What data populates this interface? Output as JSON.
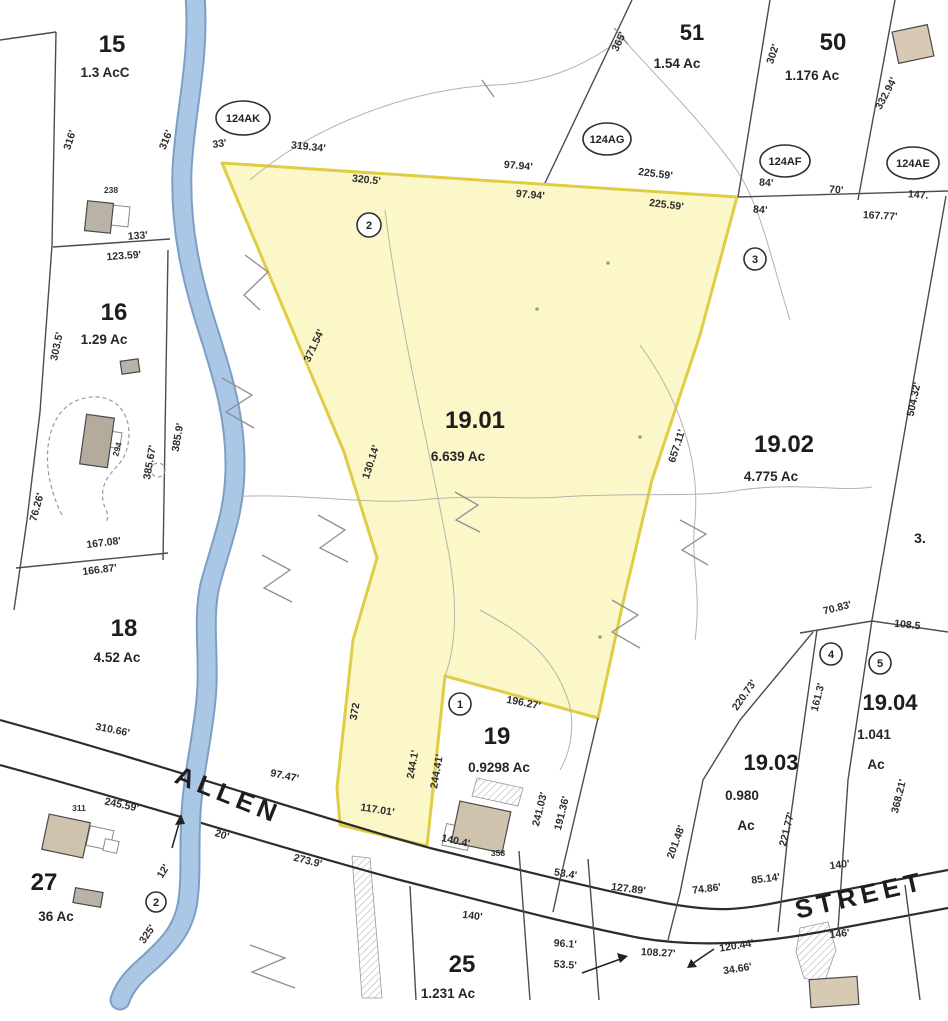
{
  "map": {
    "palette": {
      "highlight_fill": "#fbf6c3",
      "highlight_stroke": "#e0cd45",
      "river_blue": "#aac7e5",
      "river_edge": "#7d9fc6",
      "boundary": "#4c4c4c",
      "road": "#2d2d2d",
      "contour": "#b4b4aa",
      "text": "#262626"
    },
    "highlight": {
      "parcel_id": "19.01",
      "area": "6.639 Ac",
      "points": "222,163 737,197 700,335 652,480 622,607 598,718 445,676 427,846 340,825 337,788 353,640 377,558 344,452"
    },
    "shapes": {
      "river": "M195,-5 C200,60 185,110 182,170 C180,230 192,280 208,330 C224,380 236,420 235,470 C234,515 222,540 210,585 C202,620 210,660 206,700 C202,740 196,760 192,800 C188,840 192,870 188,900 C184,930 168,945 150,962 C135,975 125,985 120,1000",
      "road_casings": [
        {
          "name": "allen-street-upper-edge",
          "d": "M0,720 C160,764 300,812 430,848 C520,870 600,890 665,903 C720,913 740,910 790,900 C830,893 895,880 948,870"
        },
        {
          "name": "allen-street-lower-edge",
          "d": "M0,765 C150,806 280,848 400,880 C490,903 560,922 640,938 C700,948 760,943 820,932 C870,923 910,915 948,908"
        }
      ],
      "boundaries": [
        {
          "name": "map-edge-corner",
          "d": "M0,40 L56,32"
        },
        {
          "name": "west-lot-line",
          "d": "M56,32 L52,245 L40,412 L27,520 L14,610"
        },
        {
          "name": "lot15-16-line",
          "d": "M53,247 L170,239"
        },
        {
          "name": "lot16-east-line",
          "d": "M168,250 L163,560"
        },
        {
          "name": "lot16-18-line",
          "d": "M16,568 L168,553"
        },
        {
          "name": "lot51-west-line",
          "d": "M632,0 L545,183"
        },
        {
          "name": "lot51-50-line",
          "d": "M770,0 L738,197"
        },
        {
          "name": "lot50-east-line",
          "d": "M895,0 L858,200"
        },
        {
          "name": "north-tier-line",
          "d": "M738,197 L948,191"
        },
        {
          "name": "lot1902-east-line",
          "d": "M946,196 L917,360 L872,620"
        },
        {
          "name": "junction-line",
          "d": "M800,633 L872,621 L948,632"
        },
        {
          "name": "lot1903-west-line",
          "d": "M813,632 L740,720 L703,780 L680,893 L668,940"
        },
        {
          "name": "lot1903-1904-line",
          "d": "M817,630 L787,843 L778,932"
        },
        {
          "name": "lot1904-east-line",
          "d": "M872,620 L848,780 L838,930"
        },
        {
          "name": "lot19-east-line",
          "d": "M598,718 L560,880 L553,912"
        },
        {
          "name": "lot25-west-line",
          "d": "M410,886 L416,1000"
        },
        {
          "name": "lot25-east-line",
          "d": "M519,851 L530,1000"
        },
        {
          "name": "narrow-strip-line",
          "d": "M588,859 L599,1000"
        },
        {
          "name": "southeast-lot-line",
          "d": "M905,885 L920,1000"
        }
      ],
      "contours": [
        {
          "name": "contour-north-arc",
          "d": "M250,180 C320,120 420,88 495,85 C560,82 600,55 622,38"
        },
        {
          "name": "contour-northeast",
          "d": "M622,38 C660,80 710,130 740,175 C762,212 772,262 790,320"
        },
        {
          "name": "contour-mid-cross",
          "d": "M230,497 C300,492 360,505 420,500 C480,494 520,500 560,497 C640,492 700,498 740,490 C800,482 840,492 872,487"
        },
        {
          "name": "contour-east",
          "d": "M640,345 C680,400 700,460 695,520 C690,560 702,590 695,640"
        },
        {
          "name": "contour-center-vertical",
          "d": "M385,210 C400,330 430,450 450,560 C458,610 455,650 445,676"
        },
        {
          "name": "contour-south-center",
          "d": "M480,610 C520,632 552,652 568,700 C575,720 572,750 560,770"
        }
      ],
      "zigzags": [
        {
          "name": "stream-mark",
          "d": "M245,255 L268,272 L244,295 L260,310"
        },
        {
          "name": "stream-mark",
          "d": "M222,378 L252,395 L226,412 L254,428"
        },
        {
          "name": "stream-mark",
          "d": "M262,555 L290,570 L264,588 L292,602"
        },
        {
          "name": "stream-mark",
          "d": "M318,515 L345,530 L320,548 L348,562"
        },
        {
          "name": "stream-mark",
          "d": "M455,492 L478,505 L456,520 L480,532"
        },
        {
          "name": "stream-mark",
          "d": "M612,600 L638,615 L612,632 L640,648"
        },
        {
          "name": "stream-mark",
          "d": "M680,520 L706,534 L682,550 L708,565"
        },
        {
          "name": "stream-mark",
          "d": "M250,945 L285,958 L252,972 L295,988"
        },
        {
          "name": "contour-tick",
          "d": "M482,80 L494,97"
        },
        {
          "name": "contour-tick",
          "d": "M614,28 L628,44"
        }
      ],
      "arrows": [
        {
          "name": "dim-arrow",
          "d": "M582,973 L626,957",
          "head": "628,956 617,953 620,963"
        },
        {
          "name": "dim-arrow",
          "d": "M714,949 L689,966",
          "head": "687,968 697,967 691,959"
        },
        {
          "name": "stream-arrow",
          "d": "M172,848 L180,820",
          "head": "181,814 175,825 185,824"
        }
      ],
      "hatched": [
        {
          "name": "dirt-drive-strip",
          "points": "352,856 370,858 382,998 362,998"
        },
        {
          "name": "wetland-patch",
          "points": "800,928 828,922 836,950 824,983 804,978 796,952"
        },
        {
          "name": "driveway-lot19",
          "points": "477,778 523,788 518,806 472,796"
        }
      ],
      "dashed": [
        {
          "name": "driveway-loop-lot16",
          "d": "M62,515 C38,468 44,413 78,400 C112,388 134,412 128,444 C124,468 106,470 103,490 C100,508 112,512 106,522"
        }
      ],
      "buildings": [
        {
          "name": "building-lot15",
          "x": 86,
          "y": 202,
          "w": 26,
          "h": 30,
          "rot": 6,
          "fill": "#b9b2a6"
        },
        {
          "name": "shed-lot16",
          "x": 121,
          "y": 360,
          "w": 18,
          "h": 13,
          "rot": -8,
          "fill": "#b9b2a6"
        },
        {
          "name": "building-lot16",
          "x": 83,
          "y": 416,
          "w": 28,
          "h": 50,
          "rot": 8,
          "fill": "#b5ab9c"
        },
        {
          "name": "building-lot27",
          "x": 45,
          "y": 818,
          "w": 42,
          "h": 36,
          "rot": 12,
          "fill": "#cfc3ae"
        },
        {
          "name": "shed-lot27",
          "x": 74,
          "y": 890,
          "w": 28,
          "h": 15,
          "rot": 10,
          "fill": "#b9b2a6"
        },
        {
          "name": "building-lot19",
          "x": 455,
          "y": 806,
          "w": 52,
          "h": 42,
          "rot": 12,
          "fill": "#cfc3ae"
        },
        {
          "name": "building-northeast",
          "x": 895,
          "y": 28,
          "w": 36,
          "h": 32,
          "rot": -12,
          "fill": "#d8c9b4"
        },
        {
          "name": "building-southeast",
          "x": 810,
          "y": 978,
          "w": 48,
          "h": 28,
          "rot": -4,
          "fill": "#d8c9b4"
        }
      ],
      "building_outlines": [
        {
          "name": "garage-lot15",
          "x": 112,
          "y": 206,
          "w": 17,
          "h": 20,
          "rot": 6
        },
        {
          "name": "step-lot16",
          "x": 111,
          "y": 432,
          "w": 10,
          "h": 16,
          "rot": 8
        },
        {
          "name": "deck-lot27",
          "x": 88,
          "y": 828,
          "w": 24,
          "h": 20,
          "rot": 12
        },
        {
          "name": "deck2-lot27",
          "x": 104,
          "y": 840,
          "w": 14,
          "h": 12,
          "rot": 12
        },
        {
          "name": "garage-lot19",
          "x": 444,
          "y": 826,
          "w": 26,
          "h": 22,
          "rot": 12
        }
      ],
      "dots": [
        {
          "x": 537,
          "y": 309
        },
        {
          "x": 608,
          "y": 263
        },
        {
          "x": 640,
          "y": 437
        },
        {
          "x": 600,
          "y": 637
        }
      ]
    },
    "labels": {
      "parcel_ids": [
        {
          "t": "15",
          "x": 112,
          "y": 52,
          "s": 24
        },
        {
          "t": "16",
          "x": 114,
          "y": 320,
          "s": 24
        },
        {
          "t": "18",
          "x": 124,
          "y": 636,
          "s": 24
        },
        {
          "t": "27",
          "x": 44,
          "y": 890,
          "s": 24
        },
        {
          "t": "51",
          "x": 692,
          "y": 40,
          "s": 22
        },
        {
          "t": "50",
          "x": 833,
          "y": 50,
          "s": 24
        },
        {
          "t": "19",
          "x": 497,
          "y": 744,
          "s": 24
        },
        {
          "t": "19.01",
          "x": 475,
          "y": 428,
          "s": 24
        },
        {
          "t": "19.02",
          "x": 784,
          "y": 452,
          "s": 24
        },
        {
          "t": "19.03",
          "x": 771,
          "y": 770,
          "s": 22
        },
        {
          "t": "19.04",
          "x": 890,
          "y": 710,
          "s": 22
        },
        {
          "t": "25",
          "x": 462,
          "y": 972,
          "s": 24
        },
        {
          "t": "3.",
          "x": 920,
          "y": 543,
          "s": 14
        }
      ],
      "areas": [
        {
          "t": "1.3 AcC",
          "x": 105,
          "y": 77
        },
        {
          "t": "1.29 Ac",
          "x": 104,
          "y": 344
        },
        {
          "t": "4.52 Ac",
          "x": 117,
          "y": 662
        },
        {
          "t": "36 Ac",
          "x": 56,
          "y": 921
        },
        {
          "t": "1.54 Ac",
          "x": 677,
          "y": 68
        },
        {
          "t": "1.176 Ac",
          "x": 812,
          "y": 80
        },
        {
          "t": "6.639 Ac",
          "x": 458,
          "y": 461
        },
        {
          "t": "4.775 Ac",
          "x": 771,
          "y": 481
        },
        {
          "t": "0.9298 Ac",
          "x": 499,
          "y": 772
        },
        {
          "t": "0.980",
          "x": 742,
          "y": 800
        },
        {
          "t": "Ac",
          "x": 746,
          "y": 830
        },
        {
          "t": "1.041",
          "x": 874,
          "y": 739
        },
        {
          "t": "Ac",
          "x": 876,
          "y": 769
        },
        {
          "t": "1.231 Ac",
          "x": 448,
          "y": 998
        }
      ],
      "dims": [
        {
          "t": "316'",
          "x": 73,
          "y": 141,
          "r": -72
        },
        {
          "t": "316'",
          "x": 169,
          "y": 141,
          "r": -68
        },
        {
          "t": "33'",
          "x": 220,
          "y": 147,
          "r": -8
        },
        {
          "t": "319.34'",
          "x": 308,
          "y": 150,
          "r": 6
        },
        {
          "t": "320.5'",
          "x": 366,
          "y": 183,
          "r": 6
        },
        {
          "t": "97.94'",
          "x": 518,
          "y": 169,
          "r": 5
        },
        {
          "t": "97.94'",
          "x": 530,
          "y": 198,
          "r": 5
        },
        {
          "t": "225.59'",
          "x": 655,
          "y": 177,
          "r": 7
        },
        {
          "t": "225.59'",
          "x": 666,
          "y": 208,
          "r": 7
        },
        {
          "t": "84'",
          "x": 766,
          "y": 186,
          "r": 4
        },
        {
          "t": "84'",
          "x": 760,
          "y": 213,
          "r": 4
        },
        {
          "t": "70'",
          "x": 836,
          "y": 193,
          "r": 4
        },
        {
          "t": "147.",
          "x": 918,
          "y": 198,
          "r": 4
        },
        {
          "t": "167.77'",
          "x": 880,
          "y": 219,
          "r": 3
        },
        {
          "t": "332.94'",
          "x": 889,
          "y": 95,
          "r": -62
        },
        {
          "t": "365'",
          "x": 622,
          "y": 43,
          "r": -65
        },
        {
          "t": "302'",
          "x": 776,
          "y": 55,
          "r": -72
        },
        {
          "t": "133'",
          "x": 138,
          "y": 239,
          "r": -4
        },
        {
          "t": "123.59'",
          "x": 124,
          "y": 259,
          "r": -4
        },
        {
          "t": "303.5'",
          "x": 60,
          "y": 347,
          "r": -78
        },
        {
          "t": "385.67'",
          "x": 153,
          "y": 463,
          "r": -80
        },
        {
          "t": "385.9'",
          "x": 181,
          "y": 438,
          "r": -80
        },
        {
          "t": "76.26'",
          "x": 40,
          "y": 508,
          "r": -75
        },
        {
          "t": "167.08'",
          "x": 104,
          "y": 546,
          "r": -7
        },
        {
          "t": "166.87'",
          "x": 100,
          "y": 573,
          "r": -7
        },
        {
          "t": "310.66'",
          "x": 112,
          "y": 733,
          "r": 11
        },
        {
          "t": "97.47'",
          "x": 284,
          "y": 779,
          "r": 12
        },
        {
          "t": "245.59'",
          "x": 121,
          "y": 808,
          "r": 12
        },
        {
          "t": "20'",
          "x": 221,
          "y": 838,
          "r": 18
        },
        {
          "t": "273.9'",
          "x": 307,
          "y": 864,
          "r": 14
        },
        {
          "t": "12'",
          "x": 166,
          "y": 873,
          "r": -58
        },
        {
          "t": "325'",
          "x": 150,
          "y": 936,
          "r": -55
        },
        {
          "t": "371.54'",
          "x": 317,
          "y": 347,
          "r": -65
        },
        {
          "t": "130.14'",
          "x": 374,
          "y": 463,
          "r": -72
        },
        {
          "t": "372",
          "x": 358,
          "y": 712,
          "r": -80
        },
        {
          "t": "244.1'",
          "x": 416,
          "y": 765,
          "r": -80
        },
        {
          "t": "244.41'",
          "x": 440,
          "y": 772,
          "r": -80
        },
        {
          "t": "117.01'",
          "x": 377,
          "y": 813,
          "r": 9
        },
        {
          "t": "140.4'",
          "x": 455,
          "y": 844,
          "r": 12
        },
        {
          "t": "196.27'",
          "x": 523,
          "y": 706,
          "r": 11
        },
        {
          "t": "241.03'",
          "x": 543,
          "y": 810,
          "r": -76
        },
        {
          "t": "191.36'",
          "x": 565,
          "y": 814,
          "r": -76
        },
        {
          "t": "201.48'",
          "x": 679,
          "y": 843,
          "r": -70
        },
        {
          "t": "53.4'",
          "x": 565,
          "y": 877,
          "r": 9
        },
        {
          "t": "127.89'",
          "x": 628,
          "y": 892,
          "r": 7
        },
        {
          "t": "140'",
          "x": 472,
          "y": 919,
          "r": 7
        },
        {
          "t": "96.1'",
          "x": 565,
          "y": 947,
          "r": 4
        },
        {
          "t": "53.5'",
          "x": 565,
          "y": 968,
          "r": 4
        },
        {
          "t": "108.27'",
          "x": 658,
          "y": 956,
          "r": 3
        },
        {
          "t": "74.86'",
          "x": 707,
          "y": 892,
          "r": -7
        },
        {
          "t": "85.14'",
          "x": 766,
          "y": 882,
          "r": -7
        },
        {
          "t": "140'",
          "x": 840,
          "y": 868,
          "r": -7
        },
        {
          "t": "146'",
          "x": 840,
          "y": 937,
          "r": -7
        },
        {
          "t": "120.44'",
          "x": 737,
          "y": 949,
          "r": -9
        },
        {
          "t": "34.66'",
          "x": 738,
          "y": 972,
          "r": -9
        },
        {
          "t": "70.83'",
          "x": 838,
          "y": 611,
          "r": -14
        },
        {
          "t": "108.5",
          "x": 907,
          "y": 628,
          "r": 6
        },
        {
          "t": "220.73'",
          "x": 747,
          "y": 697,
          "r": -55
        },
        {
          "t": "161.3'",
          "x": 821,
          "y": 698,
          "r": -76
        },
        {
          "t": "221.77'",
          "x": 790,
          "y": 830,
          "r": -76
        },
        {
          "t": "368.21'",
          "x": 902,
          "y": 797,
          "r": -76
        },
        {
          "t": "504.32'",
          "x": 917,
          "y": 400,
          "r": -78
        },
        {
          "t": "657.11'",
          "x": 680,
          "y": 447,
          "r": -72
        }
      ],
      "house_numbers": [
        {
          "t": "238",
          "x": 111,
          "y": 193,
          "r": 0
        },
        {
          "t": "294",
          "x": 120,
          "y": 450,
          "r": -75
        },
        {
          "t": "311",
          "x": 79,
          "y": 811,
          "r": 0
        },
        {
          "t": "358",
          "x": 498,
          "y": 856,
          "r": 0
        }
      ],
      "roads": [
        {
          "t": "ALLEN",
          "x": 225,
          "y": 803,
          "r": 22
        },
        {
          "t": "STREET",
          "x": 862,
          "y": 904,
          "r": -13
        }
      ],
      "ovals": [
        {
          "t": "124AK",
          "cx": 243,
          "cy": 118,
          "rx": 27,
          "ry": 17
        },
        {
          "t": "124AG",
          "cx": 607,
          "cy": 139,
          "rx": 24,
          "ry": 16
        },
        {
          "t": "124AF",
          "cx": 785,
          "cy": 161,
          "rx": 25,
          "ry": 16
        },
        {
          "t": "124AE",
          "cx": 913,
          "cy": 163,
          "rx": 26,
          "ry": 16
        }
      ],
      "circles": [
        {
          "t": "2",
          "cx": 369,
          "cy": 225,
          "rr": 12
        },
        {
          "t": "3",
          "cx": 755,
          "cy": 259,
          "rr": 11
        },
        {
          "t": "1",
          "cx": 460,
          "cy": 704,
          "rr": 11
        },
        {
          "t": "2",
          "cx": 156,
          "cy": 902,
          "rr": 10
        },
        {
          "t": "4",
          "cx": 831,
          "cy": 654,
          "rr": 11
        },
        {
          "t": "5",
          "cx": 880,
          "cy": 663,
          "rr": 11
        }
      ]
    }
  }
}
